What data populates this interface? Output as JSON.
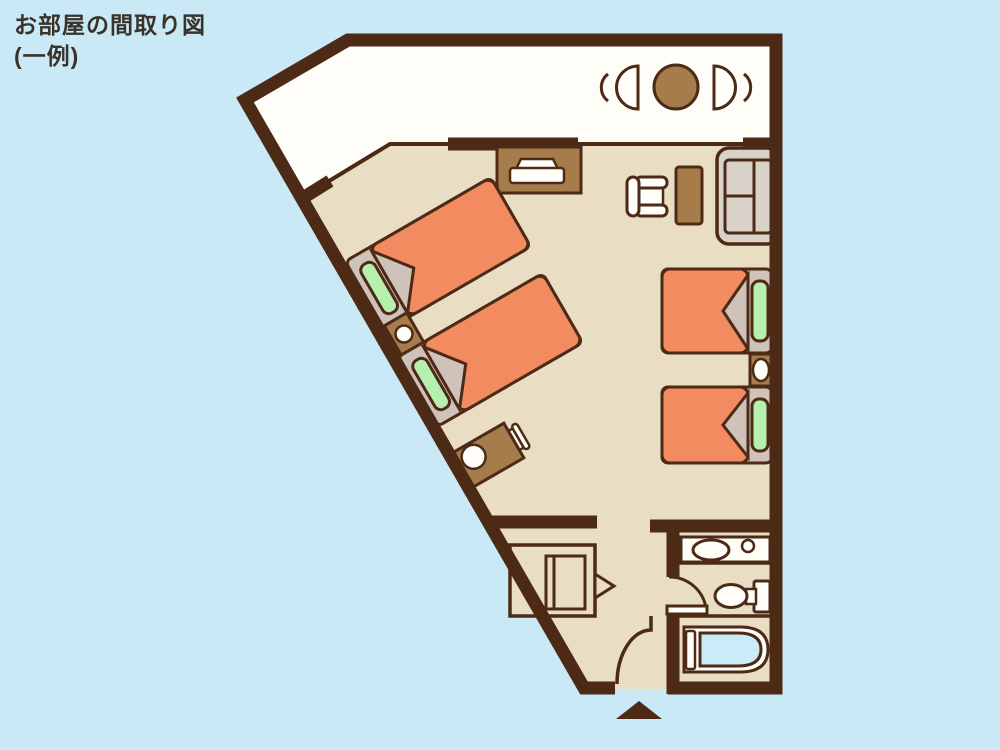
{
  "title": {
    "line1": "お部屋の間取り図",
    "line2": "(一例)"
  },
  "colors": {
    "background": "#c9e9f6",
    "wall": "#4d2a16",
    "floor": "#e9ddc4",
    "balcony": "#fffdf8",
    "furniture_brown": "#a67c4a",
    "bed_orange": "#f28b5f",
    "pillow_green": "#b6f0af",
    "bed_frame": "#cfc2b8",
    "sofa_fabric": "#d9d2c8",
    "fixture_white": "#fffef9",
    "water_blue": "#c9ecf8",
    "title_text": "#3a332c"
  },
  "items": [
    "balcony",
    "round-table",
    "balcony-chairs",
    "tv-cabinet",
    "tv",
    "bed-1",
    "bed-2",
    "bed-3",
    "bed-4",
    "nightstand-1",
    "nightstand-2",
    "armchair",
    "side-table",
    "sofa",
    "desk",
    "desk-stool",
    "desk-chair",
    "closet",
    "washbasin",
    "toilet",
    "bathtub",
    "bathroom-door",
    "entrance-door",
    "entrance-marker"
  ]
}
